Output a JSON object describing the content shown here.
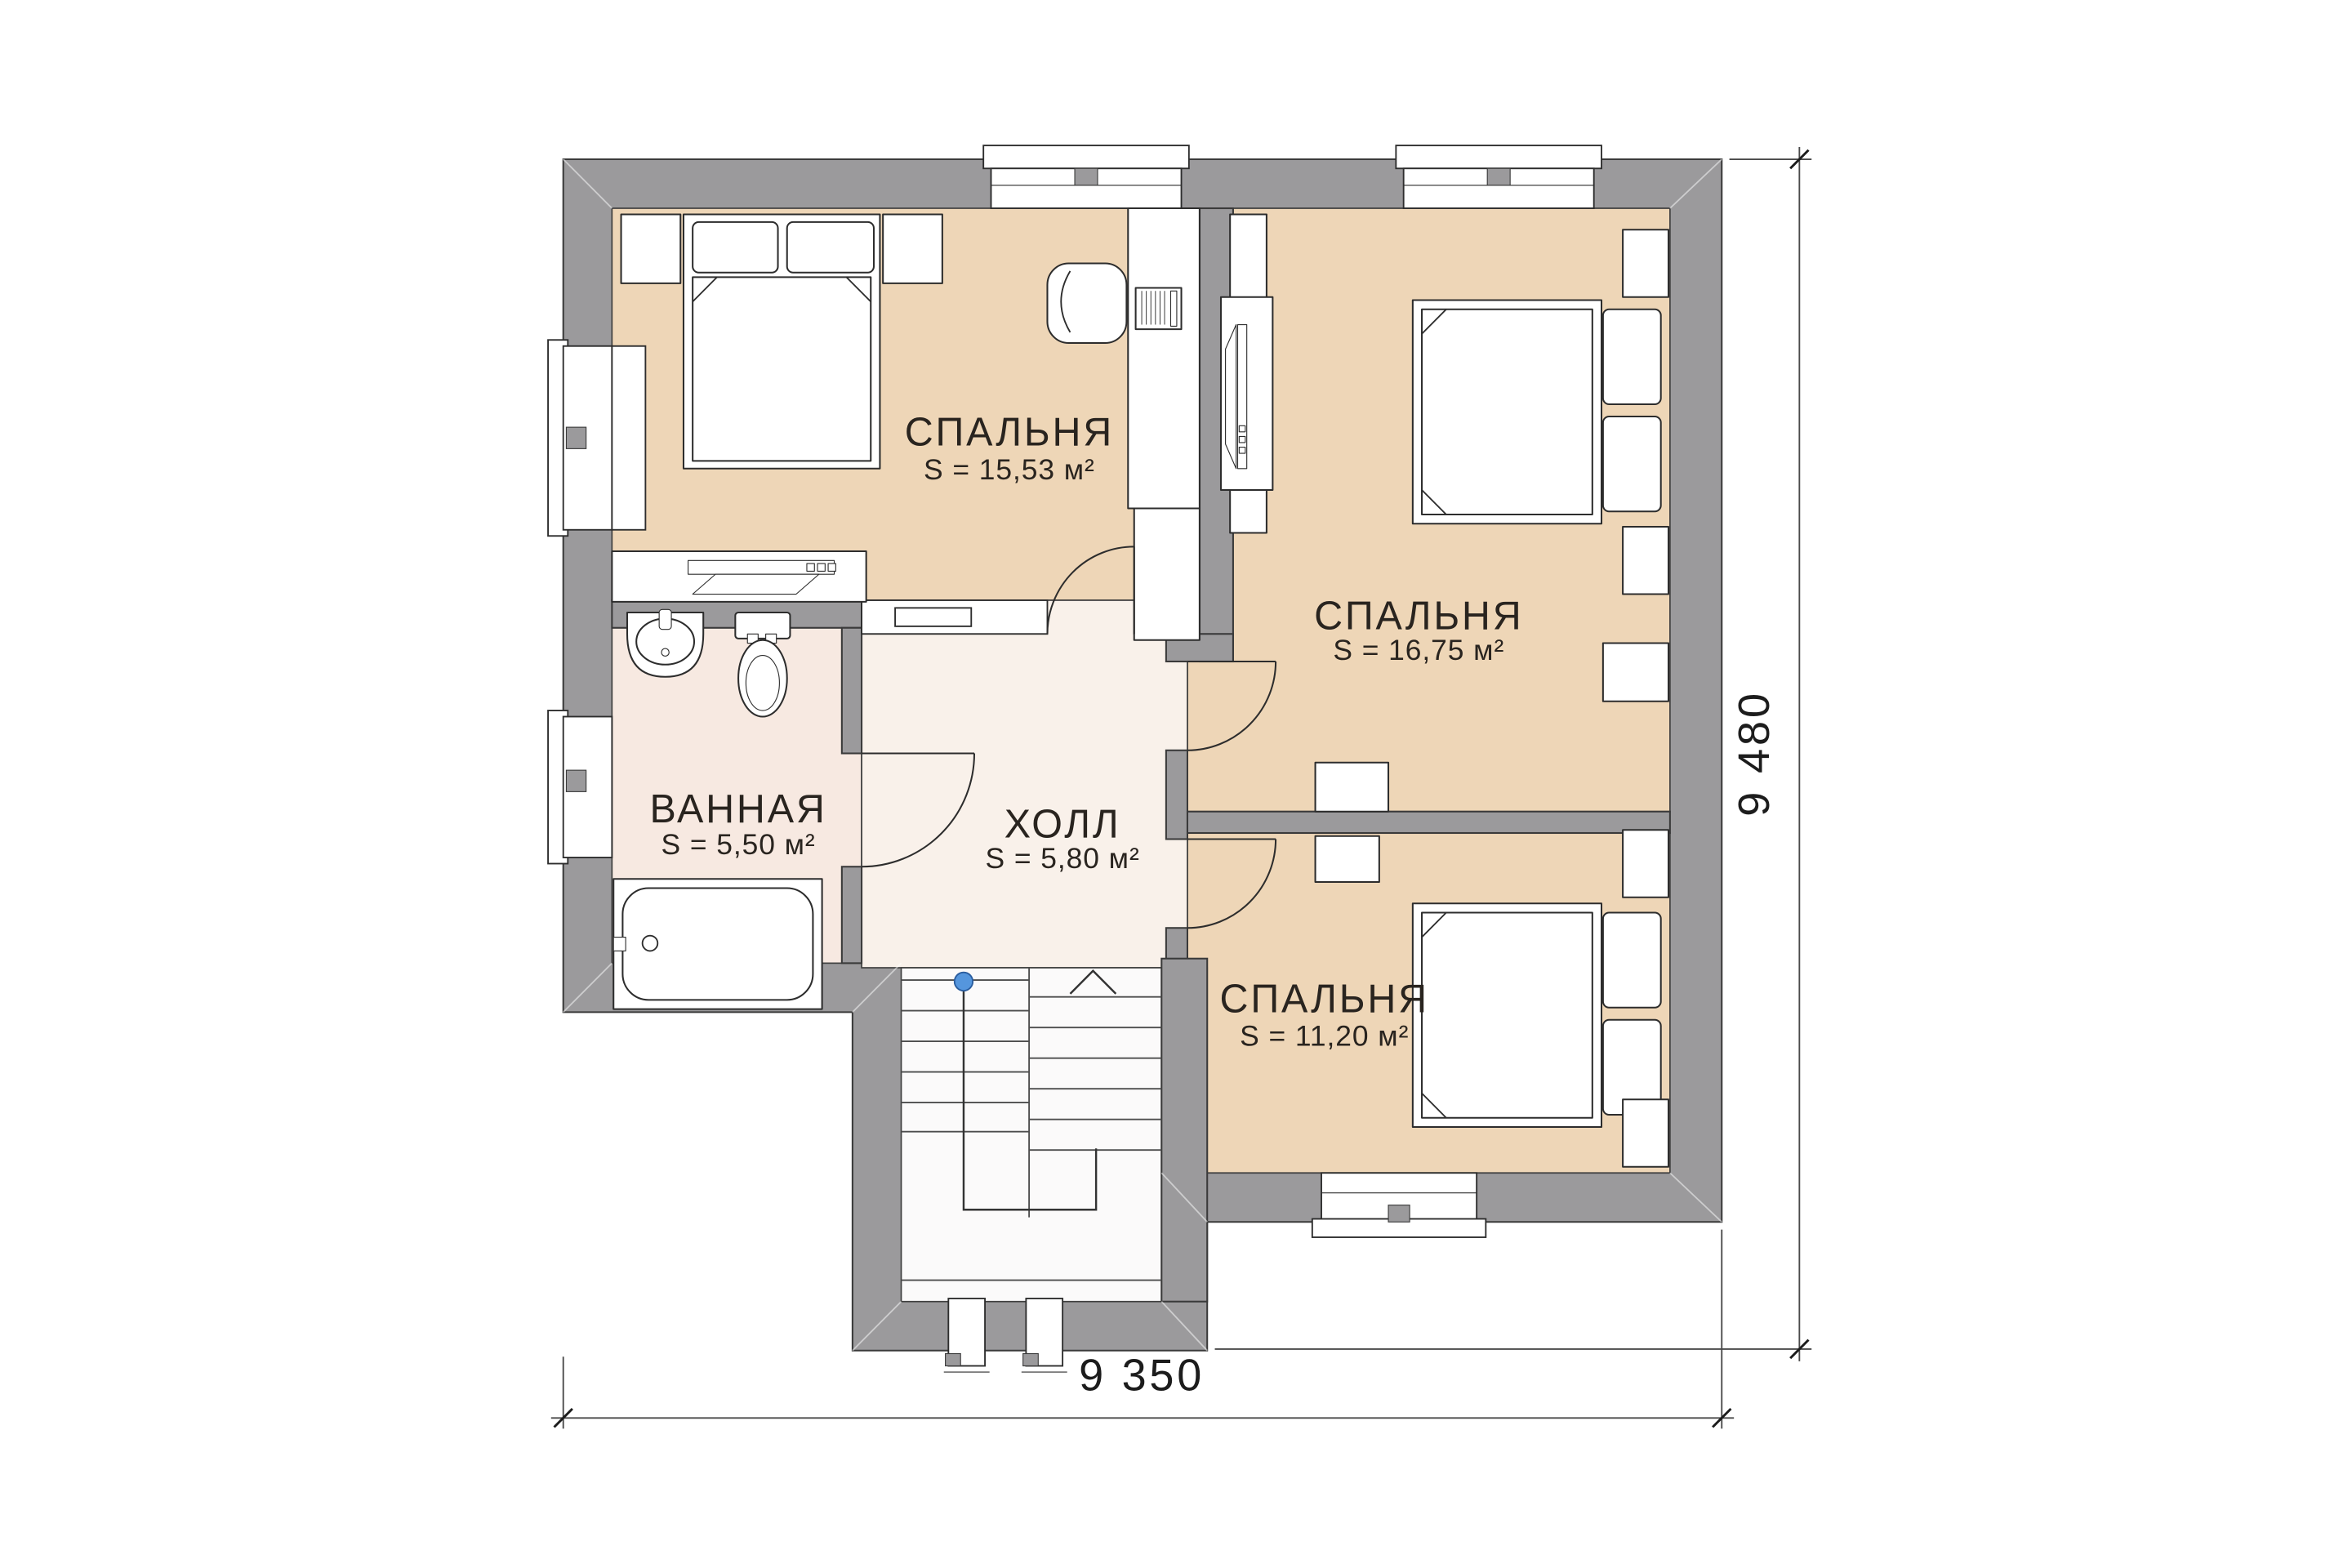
{
  "plan": {
    "rooms": [
      {
        "id": "bedroom-1",
        "name": "СПАЛЬНЯ",
        "area": "S = 15,53 м²"
      },
      {
        "id": "bedroom-2",
        "name": "СПАЛЬНЯ",
        "area": "S = 16,75 м²"
      },
      {
        "id": "bedroom-3",
        "name": "СПАЛЬНЯ",
        "area": "S = 11,20 м²"
      },
      {
        "id": "bathroom",
        "name": "ВАННАЯ",
        "area": "S = 5,50 м²"
      },
      {
        "id": "hall",
        "name": "ХОЛЛ",
        "area": "S = 5,80 м²"
      }
    ],
    "dimensions": {
      "width_label": "9 350",
      "height_label": "9 480"
    },
    "colors": {
      "wall": "#9b9a9c",
      "bedroom_floor": "#eed6b7",
      "bathroom_floor": "#f7e9e1",
      "hall_floor": "#f9f1ea",
      "stair_floor": "#fbfafa",
      "handrail_dot": "#5596dd"
    }
  }
}
